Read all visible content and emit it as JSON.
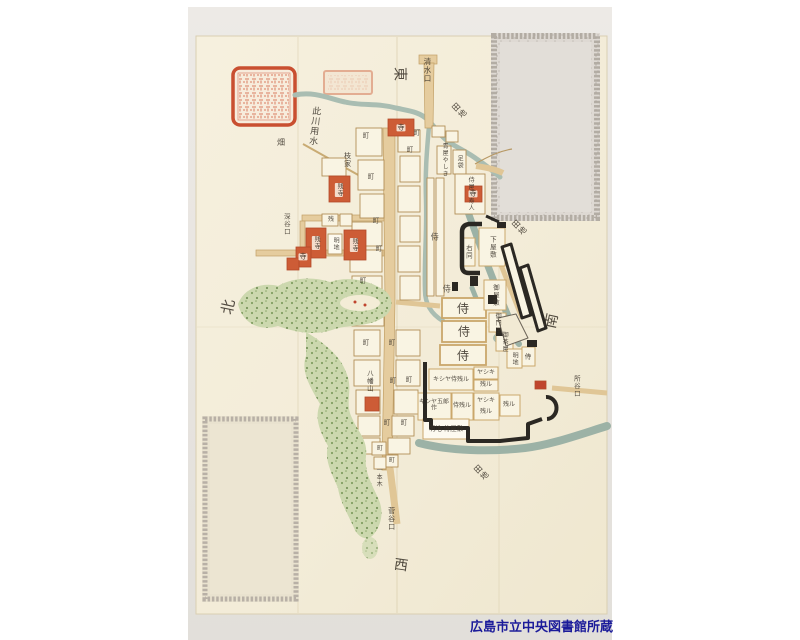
{
  "credit": "広島市立中央図書館所蔵",
  "compass": {
    "top_east": "東",
    "bottom_west": "西",
    "left_north": "北",
    "right_south": "南"
  },
  "gates": {
    "shimizuguchi": "清水口",
    "fukataniguchi": "深谷口",
    "sugataniguchi": "菅谷口",
    "tokorotaniguchi": "所谷口"
  },
  "waterway": {
    "kono_kawa_yousui": "此川用水"
  },
  "fields": {
    "denchi": "田地",
    "hatake": "畑",
    "edaie": "枝家"
  },
  "hill": {
    "hachimanyama": "八幡山",
    "ippongi": "一本木"
  },
  "town": {
    "machi": "町",
    "akichi": "明地",
    "nokoru_short": "残",
    "nokoru": "残ル",
    "yashiki": "ヤシキ",
    "kishiya_samurai": "キシヤ侍残ル",
    "kishiya_gorosaku": "キシヤ五郎作",
    "samurai_nokoru": "侍残ル",
    "akichi_samurai_yashiki": "明地 侍屋敷"
  },
  "samurai": {
    "samurai": "侍",
    "samurai_yashiki_jin": "侍屋敷寿人",
    "aoya_yashiki": "青屋やしき",
    "tabi": "足袋"
  },
  "temples": {
    "tera": "寺",
    "nokoru_tera": "残寺"
  },
  "castle": {
    "shimo_yashiki": "下屋敷",
    "migi_onaji": "右同",
    "o_yashiki": "御屋敷",
    "gomon": "御門屋",
    "ochaya": "御茶屋",
    "akichi": "明地",
    "samurai": "侍"
  },
  "colors": {
    "paper": "#f4eedb",
    "photo_bg": "#e8e5e1",
    "river": "#a9bdb2",
    "moat": "#9cb2a6",
    "road": "#e5cc9e",
    "temple_red": "#cd5c36",
    "wall_black": "#2b2823",
    "vegetation": "#ccd8ae",
    "seal_red": "#c94f30",
    "credit_blue": "#1a1a99"
  }
}
